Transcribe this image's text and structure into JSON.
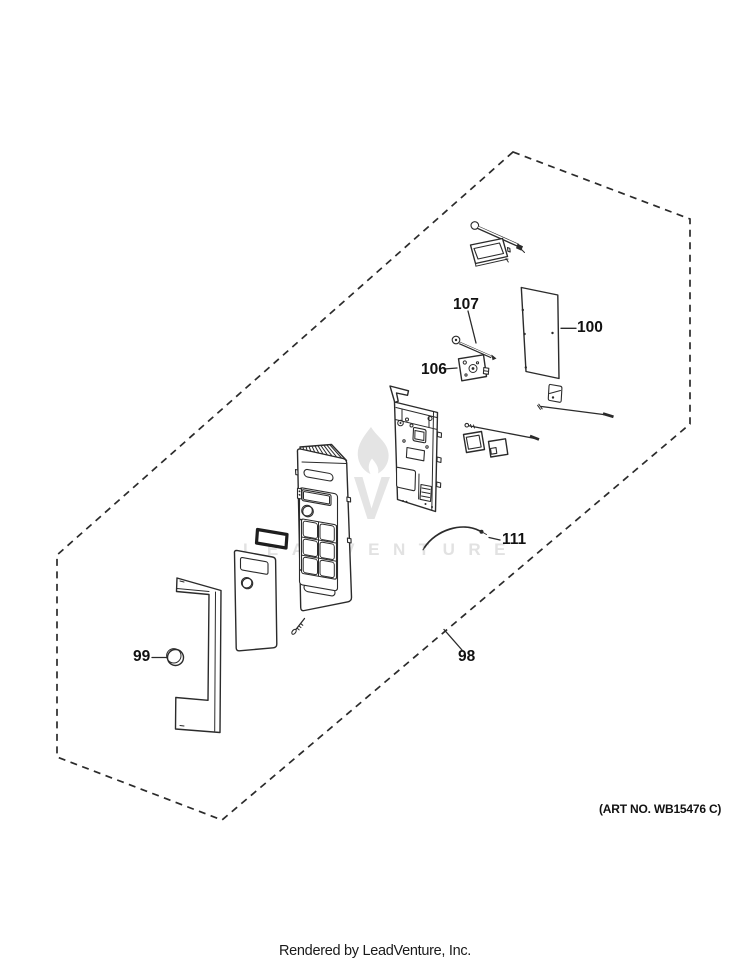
{
  "watermark": {
    "text": "LEADVENTURE",
    "logo": "leadventure-flame-logo"
  },
  "callouts": {
    "c98": "98",
    "c99": "99",
    "c100": "100",
    "c106": "106",
    "c107": "107",
    "c111": "111"
  },
  "footer": {
    "art_no": "(ART NO. WB15476 C)",
    "rendered_by": "Rendered by LeadVenture, Inc."
  },
  "colors": {
    "line": "#2b2b2b",
    "watermark": "#e4e4e4",
    "background": "#ffffff"
  }
}
